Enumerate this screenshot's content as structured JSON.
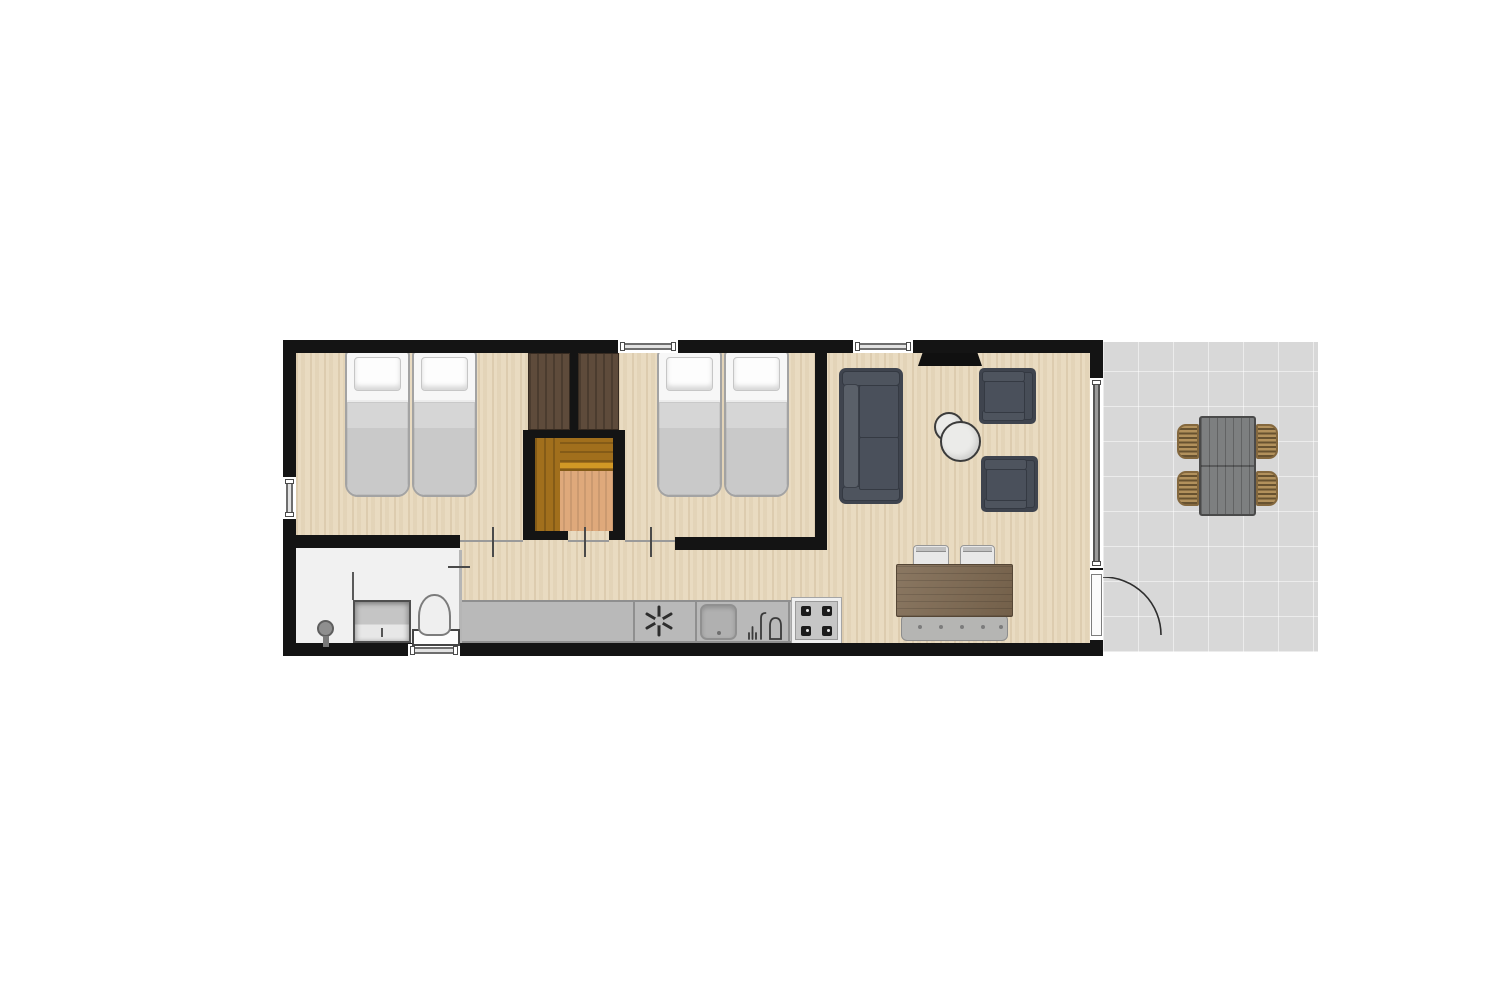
{
  "type": "floor-plan",
  "title": "Holiday home floor plan with terrace",
  "colors": {
    "background": "#ffffff",
    "wall": "#141414",
    "wood_floor": "#e9dbc1",
    "bathroom_floor": "#f1f1f1",
    "terrace_tile": "#d8d8d8",
    "counter": "#b9b9b9",
    "counter_edge": "#8f8f8f",
    "upholstery": "#4a505b",
    "upholstery_frame": "#3f444e",
    "upholstery_light": "#5a6069",
    "wardrobe_wood": "#5e4b3b",
    "closet_dark_wood": "#a16f1c",
    "closet_light_wood": "#dfa97b",
    "dining_table_wood": "#7d6850",
    "bench_gray": "#b5b5b3",
    "bed_blanket": "#c9c9c9",
    "bed_linen": "#f7f7f7",
    "outdoor_table": "#7d7f80",
    "wicker": "#b2915c",
    "door_arc": "#2e2e2e",
    "window_frame": "#6e6e6e"
  },
  "rooms": [
    {
      "name": "bedroom-1",
      "furniture": [
        "single-bed",
        "single-bed",
        "wardrobe"
      ]
    },
    {
      "name": "bedroom-2",
      "furniture": [
        "single-bed",
        "single-bed",
        "wardrobe"
      ]
    },
    {
      "name": "storage-closet",
      "furniture": [
        "built-in-cabinet"
      ]
    },
    {
      "name": "bathroom",
      "furniture": [
        "shower",
        "washbasin-vanity",
        "toilet"
      ]
    },
    {
      "name": "hallway",
      "furniture": []
    },
    {
      "name": "kitchen",
      "furniture": [
        "counter",
        "extractor-fan-symbol",
        "sink",
        "tap",
        "hob-4-burner"
      ]
    },
    {
      "name": "living-room",
      "furniture": [
        "tv",
        "sofa",
        "armchair",
        "armchair",
        "coffee-table-set-2",
        "dining-table",
        "dining-chair",
        "dining-chair",
        "dining-bench"
      ]
    },
    {
      "name": "terrace",
      "furniture": [
        "outdoor-table",
        "wicker-chair",
        "wicker-chair",
        "wicker-chair",
        "wicker-chair"
      ]
    }
  ],
  "openings": {
    "windows": [
      "bedroom-1-left-window",
      "bedroom-2-top-window",
      "living-room-top-window",
      "bathroom-bottom-window"
    ],
    "doors": [
      "bedroom-1-doorway",
      "closet-doorway",
      "bedroom-2-doorway",
      "bathroom-doorway",
      "sliding-glass-door",
      "entrance-door-with-swing"
    ]
  }
}
